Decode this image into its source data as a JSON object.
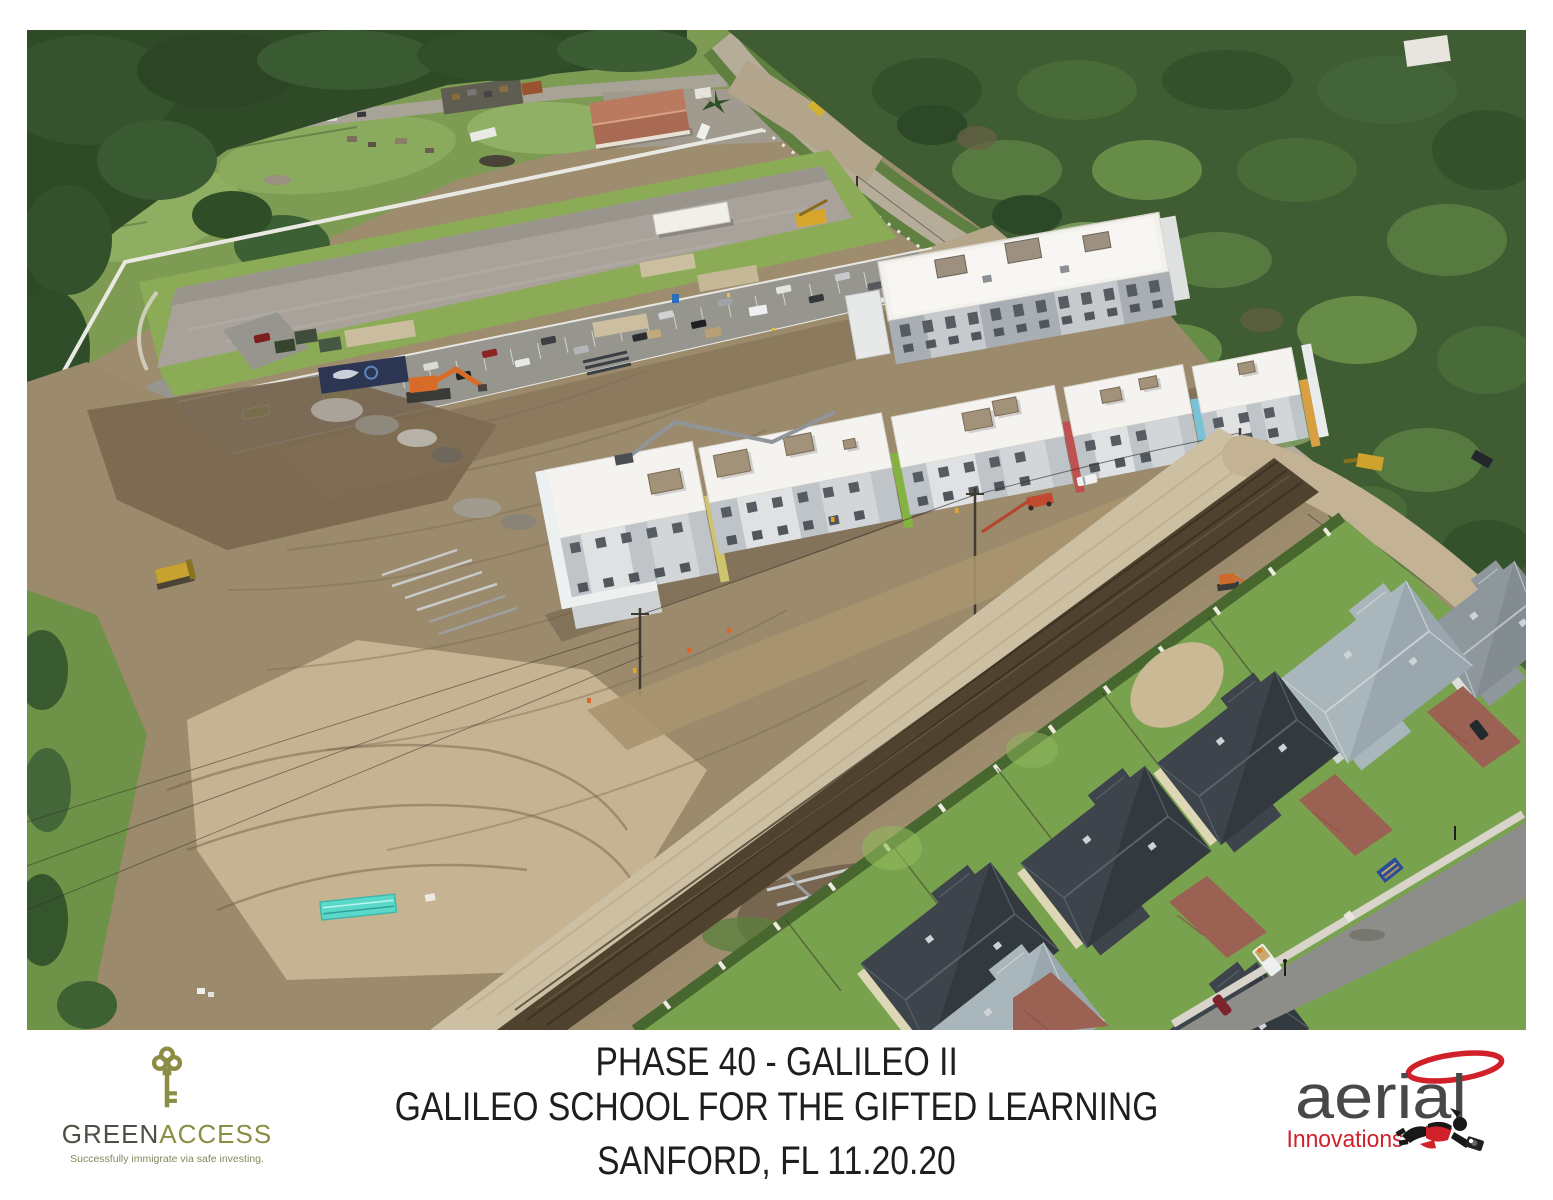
{
  "caption": {
    "line1": "PHASE 40 - GALILEO II",
    "line2": "GALILEO SCHOOL FOR THE GIFTED LEARNING",
    "line3": "SANFORD, FL 11.20.20"
  },
  "footer_logos": {
    "green_access": {
      "brand_primary": "GREEN",
      "brand_secondary": "ACCESS",
      "tagline": "Successfully immigrate via safe investing.",
      "colors": {
        "olive": "#8b8d44",
        "charcoal": "#4b5045"
      }
    },
    "aerial_innovations": {
      "brand": "aerial",
      "sub_brand": "Innovations",
      "colors": {
        "red": "#d0202a",
        "gray": "#48484a"
      }
    }
  },
  "photo": {
    "accent_stripe_colors": [
      "#cec46d",
      "#83b441",
      "#bf5150",
      "#79c2d8",
      "#d9a043"
    ]
  }
}
